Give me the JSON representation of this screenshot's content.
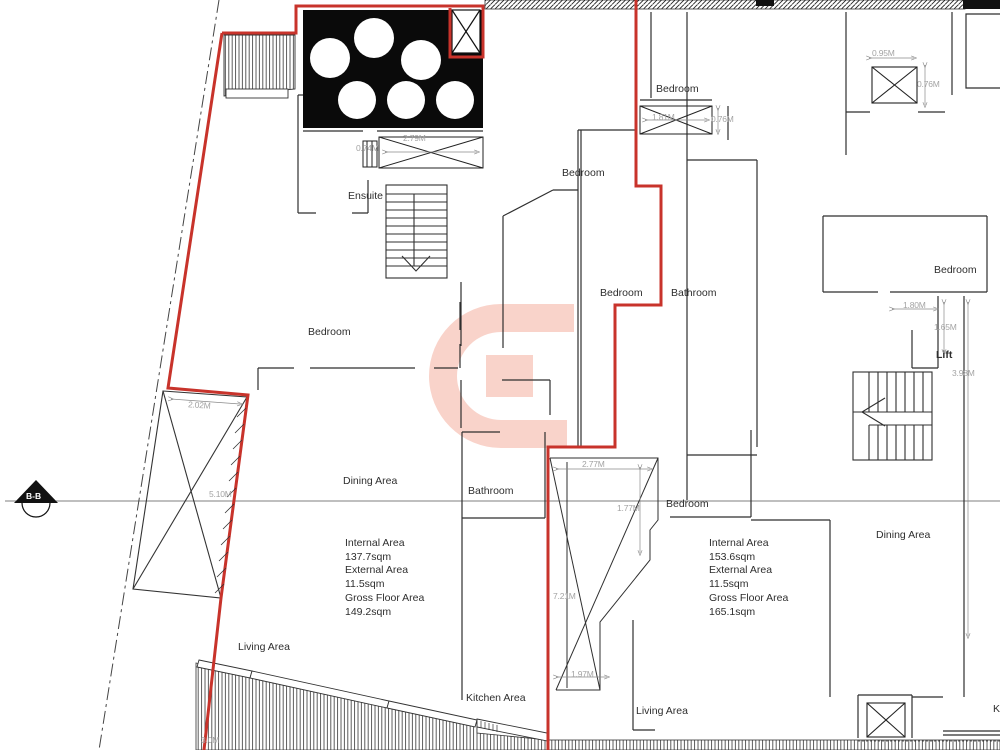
{
  "title": "Apartment floor plan drawing",
  "colors": {
    "boundary_red": "#c8332b",
    "wall": "#2f2f2f",
    "dimension_text": "#a3a3a3",
    "watermark_pink": "#f9d3ca"
  },
  "watermark": {
    "glyph": "G"
  },
  "section_marker": {
    "label": "B-B"
  },
  "rooms": {
    "ensuite": "Ensuite",
    "bedroom_left": "Bedroom",
    "bedroom_top_mid": "Bedroom",
    "bedroom_mid": "Bedroom",
    "bathroom_mid": "Bathroom",
    "bedroom_top_right": "Bedroom",
    "bedroom_far_right": "Bedroom",
    "lift": "Lift",
    "dining_left": "Dining Area",
    "bathroom_left": "Bathroom",
    "bedroom_right": "Bedroom",
    "dining_right": "Dining Area",
    "living_left": "Living Area",
    "kitchen_left": "Kitchen Area",
    "living_right": "Living Area",
    "kitchen_right_partial": "K"
  },
  "areas": {
    "left_unit": {
      "internal_label": "Internal Area",
      "internal_value": "137.7sqm",
      "external_label": "External Area",
      "external_value": "11.5sqm",
      "gross_label": "Gross Floor Area",
      "gross_value": "149.2sqm"
    },
    "right_unit": {
      "internal_label": "Internal Area",
      "internal_value": "153.6sqm",
      "external_label": "External Area",
      "external_value": "11.5sqm",
      "gross_label": "Gross Floor Area",
      "gross_value": "165.1sqm"
    }
  },
  "dimensions": {
    "tank_window_small": "0.74M",
    "tank_window_large": "2.79M",
    "window_left": "1.81M",
    "window_left_depth": "0.76M",
    "shaft_top_width": "0.95M",
    "shaft_top_depth": "0.76M",
    "terrace_width": "2.02M",
    "terrace_length": "5.10M",
    "yard_top": "2.77M",
    "yard_step": "1.77M",
    "yard_height": "7.21M",
    "yard_bottom": "1.97M",
    "lift_width": "1.80M",
    "lift_depth": "1.65M",
    "stair_length": "3.98M",
    "bottom_edge_partial": "3.0M"
  }
}
